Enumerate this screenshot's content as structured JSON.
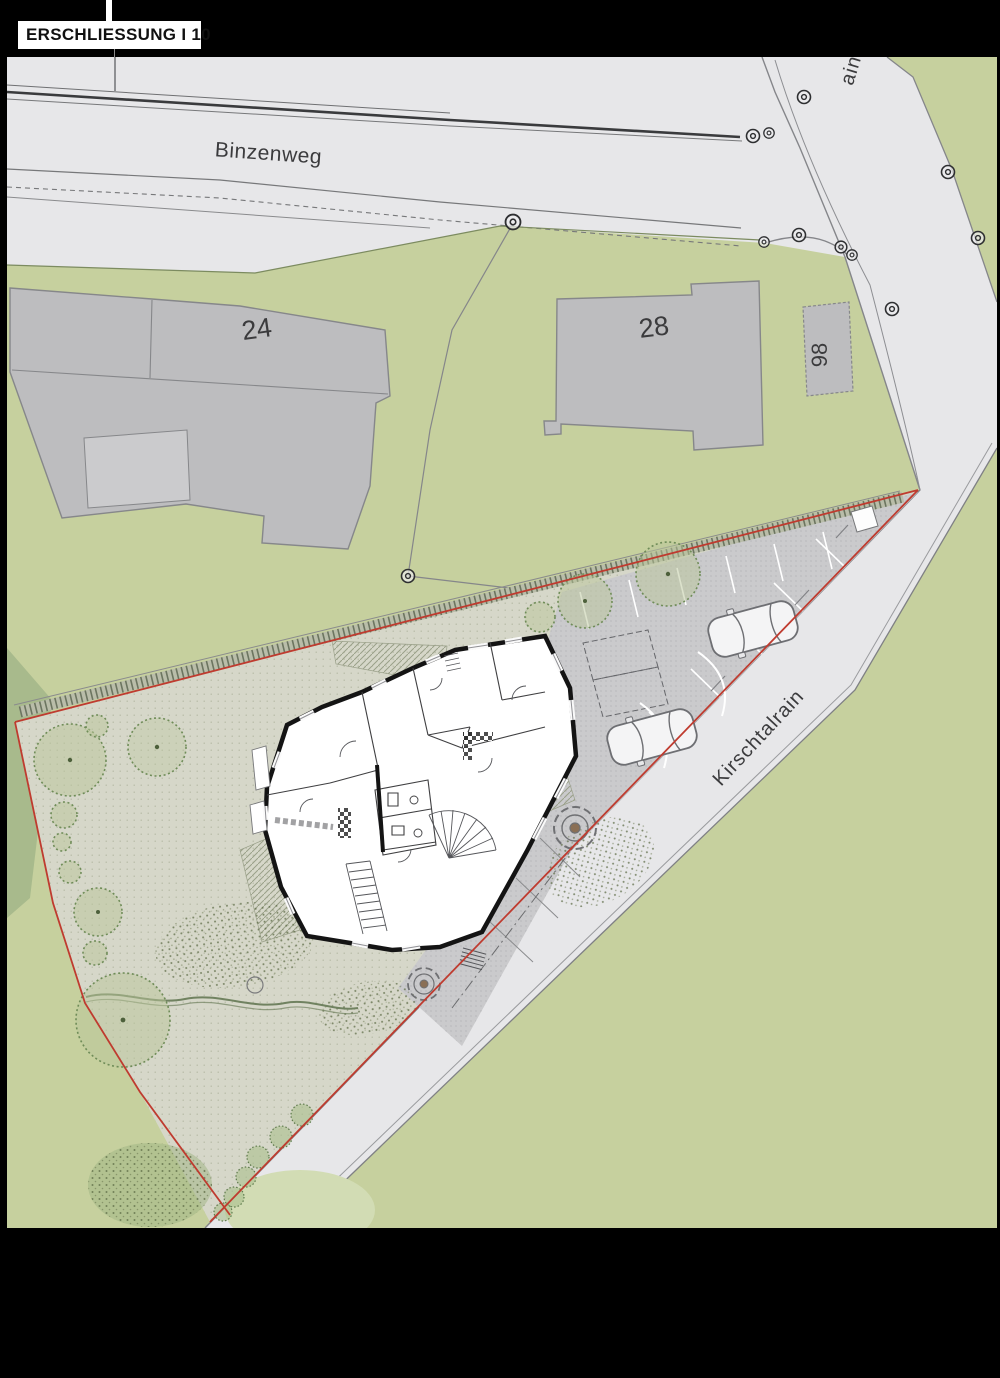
{
  "header": {
    "title": "ERSCHLIESSUNG I 10"
  },
  "map": {
    "street_labels": {
      "binzenweg": "Binzenweg",
      "kirschtalrain": "Kirschtalrain",
      "top_fragment": "ain"
    },
    "building_numbers": {
      "b24": "24",
      "b28": "28",
      "b98": "98"
    }
  },
  "icons": {
    "survey_marker": "double-circle boundary point",
    "car": "parked car top view",
    "tree": "stippled tree canopy",
    "stairs": "stair treads",
    "fountain": "concentric circular paving"
  },
  "colors": {
    "background": "#000000",
    "road": "#e7e7e9",
    "green": "#c6d09e",
    "green_dark": "#a8ba8c",
    "parcel_garden": "#d6d7c9",
    "paving": "#cacacc",
    "building_gray": "#bdbdbf",
    "boundary_red": "#bf3b2f",
    "plan_wall": "#141414",
    "label_text": "#3b3b3d",
    "title_bg": "#ffffff",
    "title_text": "#111111"
  }
}
